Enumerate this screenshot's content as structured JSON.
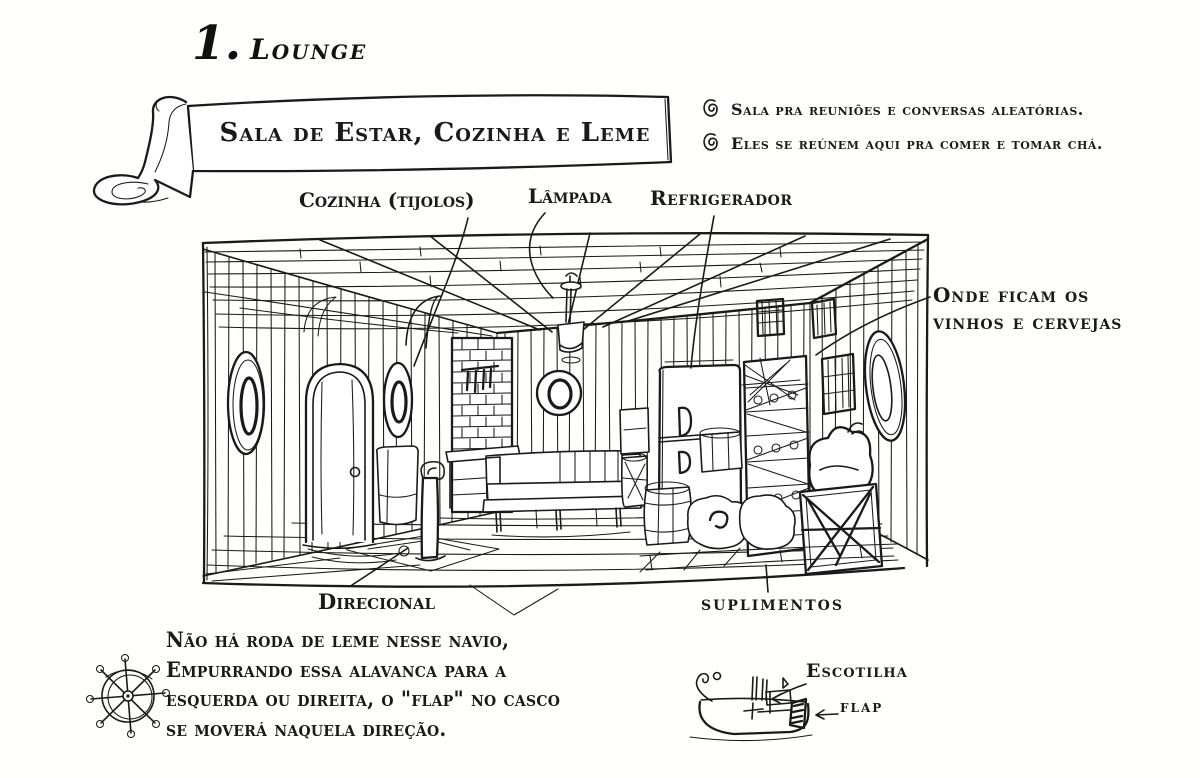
{
  "title": {
    "number": "1.",
    "text": "Lounge"
  },
  "banner": {
    "text": "Sala de Estar, Cozinha e Leme"
  },
  "notes": [
    {
      "text": "Sala pra reuniões e conversas aleatórias."
    },
    {
      "text": "Eles se reúnem aqui pra comer e tomar chá."
    }
  ],
  "labels": {
    "kitchen": "Cozinha (tijolos)",
    "lamp": "Lâmpada",
    "fridge": "Refrigerador",
    "wines": "Onde ficam os\nvinhos e cervejas",
    "lever": "Direcional",
    "supplies": "suplimentos"
  },
  "footnote": "Não há roda de leme nesse navio,\nEmpurrando essa alavanca para a\nesquerda ou direita, o \"flap\" no casco\nse moverá naquela direção.",
  "boat_labels": {
    "hatch": "Escotilha",
    "flap": "flap"
  },
  "icons": {
    "bullets": "spiral-icon",
    "wheel": "helm-wheel-icon",
    "boat": "boat-sketch"
  },
  "colors": {
    "ink": "#1a1a1a",
    "paper": "#fffffe"
  }
}
